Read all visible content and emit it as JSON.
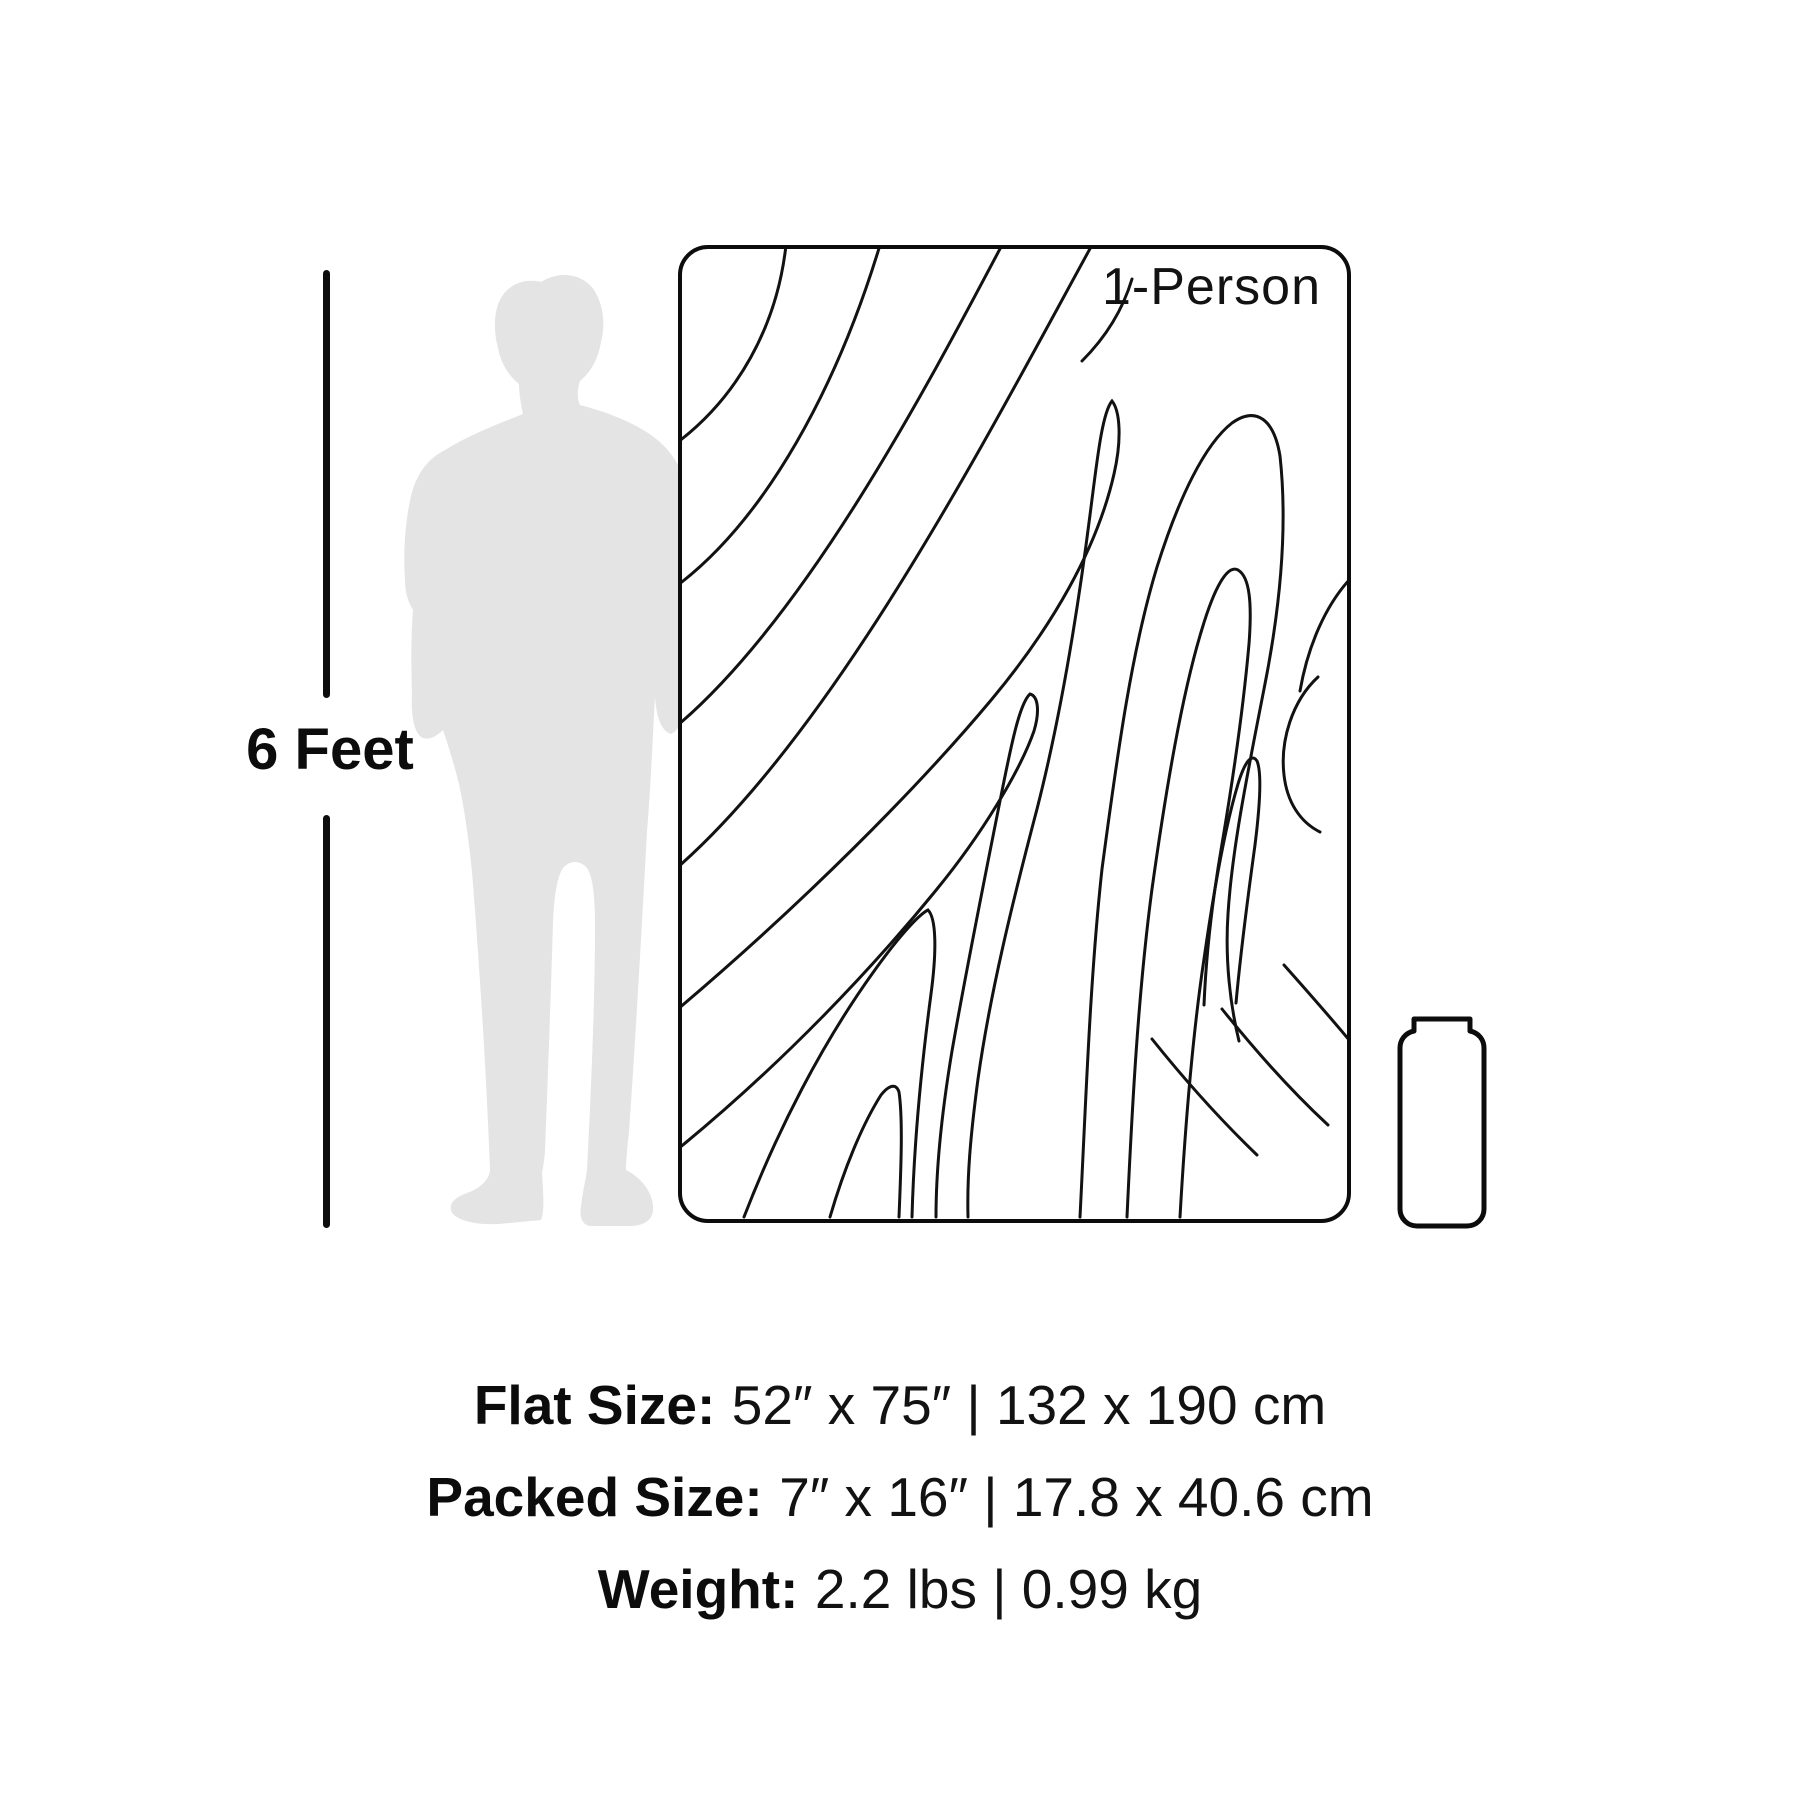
{
  "figure": {
    "height_label": "6 Feet"
  },
  "blanket": {
    "badge": "1-Person"
  },
  "specs": {
    "flat": {
      "label": "Flat Size:",
      "value": "52″ x 75″ | 132 x 190 cm"
    },
    "packed": {
      "label": "Packed Size:",
      "value": "7″ x 16″ | 17.8 x 40.6 cm"
    },
    "weight": {
      "label": "Weight:",
      "value": "2.2 lbs | 0.99 kg"
    }
  },
  "icons": {
    "person": "person-silhouette",
    "ruler": "height-ruler-line",
    "blanket": "topo-contour-blanket",
    "bag": "packed-stuff-sack"
  },
  "colors": {
    "ink": "#121212",
    "outline": "#0c0c0c",
    "silhouette": "#e4e4e4",
    "background": "#ffffff"
  }
}
